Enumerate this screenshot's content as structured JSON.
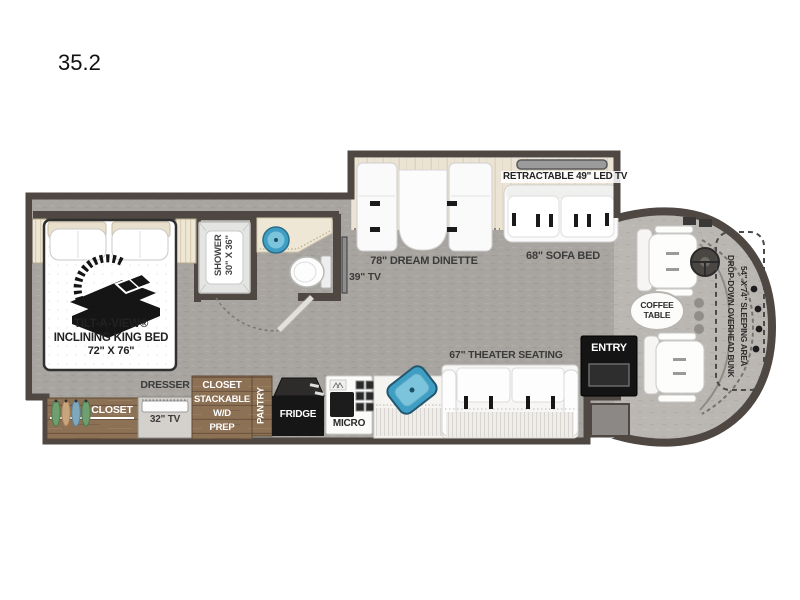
{
  "title": "35.2",
  "colors": {
    "wall": "#4e4742",
    "floor_gray": "#a8a5a0",
    "cab_floor": "#bab7b2",
    "slide_floor_cream": "#ebe3d3",
    "wood_brown": "#8d7155",
    "sink_blue": "#3f9ec4",
    "appliance_black": "#161616",
    "label_text": "#3b3b3b"
  },
  "bedroom": {
    "bed_line1": "TILT-A-VIEW®",
    "bed_line2": "INCLINING KING BED",
    "bed_line3": "72\" X 76\"",
    "closet_label": "CLOSET",
    "dresser_label": "DRESSER",
    "tv_label": "32\" TV",
    "wd_line1": "CLOSET",
    "wd_line2": "STACKABLE",
    "wd_line3": "W/D",
    "wd_line4": "PREP"
  },
  "bathroom": {
    "shower_line1": "SHOWER",
    "shower_line2": "30\" X 36\"",
    "tv_label": "39\" TV"
  },
  "kitchen": {
    "pantry_label": "PANTRY",
    "fridge_label": "FRIDGE",
    "micro_label": "MICRO"
  },
  "living": {
    "dinette_label": "78\" DREAM DINETTE",
    "retractable_tv_label": "RETRACTABLE 49\" LED TV",
    "sofa_label": "68\" SOFA BED",
    "theater_label": "67\" THEATER SEATING"
  },
  "cab": {
    "coffee_line1": "COFFEE",
    "coffee_line2": "TABLE",
    "bunk_line1": "DROP-DOWN OVERHEAD BUNK",
    "bunk_line2": "54\" X 74\" SLEEPING AREA",
    "entry_label": "ENTRY"
  }
}
